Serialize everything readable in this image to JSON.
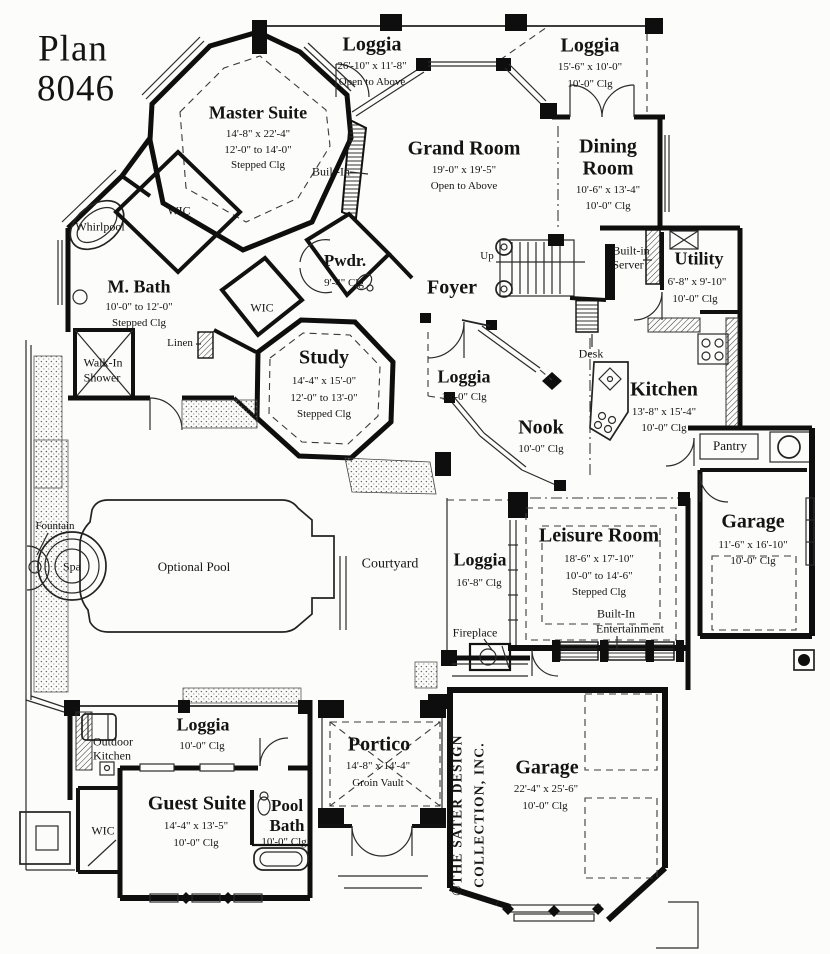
{
  "plan": {
    "title": "Plan",
    "number": "8046"
  },
  "copyright": {
    "line1": "©THE SATER DESIGN",
    "line2": "COLLECTION, INC."
  },
  "rooms": {
    "loggia_top": {
      "name": "Loggia",
      "dim": "26'-10\" x 11'-8\"",
      "note": "Open to Above"
    },
    "loggia_upper_right": {
      "name": "Loggia",
      "dim": "15'-6\" x 10'-0\"",
      "clg": "10'-0\" Clg"
    },
    "master_suite": {
      "name": "Master Suite",
      "dim": "14'-8\" x 22'-4\"",
      "clg": "12'-0\" to 14'-0\"",
      "clg2": "Stepped Clg"
    },
    "grand_room": {
      "name": "Grand Room",
      "dim": "19'-0\" x 19'-5\"",
      "note": "Open to Above"
    },
    "dining_room": {
      "name": "Dining",
      "name2": "Room",
      "dim": "10'-6\" x 13'-4\"",
      "clg": "10'-0\" Clg"
    },
    "m_bath": {
      "name": "M. Bath",
      "clg": "10'-0\" to 12'-0\"",
      "clg2": "Stepped Clg"
    },
    "pwdr": {
      "name": "Pwdr.",
      "clg": "9'-4\" Clg"
    },
    "study": {
      "name": "Study",
      "dim": "14'-4\" x 15'-0\"",
      "clg": "12'-0\" to 13'-0\"",
      "clg2": "Stepped Clg"
    },
    "foyer": {
      "name": "Foyer"
    },
    "utility": {
      "name": "Utility",
      "dim": "6'-8\" x 9'-10\"",
      "clg": "10'-0\" Clg"
    },
    "kitchen": {
      "name": "Kitchen",
      "dim": "13'-8\" x 15'-4\"",
      "clg": "10'-0\" Clg"
    },
    "nook": {
      "name": "Nook",
      "clg": "10'-0\" Clg"
    },
    "loggia_mid": {
      "name": "Loggia",
      "clg": "10'-0\" Clg"
    },
    "leisure": {
      "name": "Leisure Room",
      "dim": "18'-6\" x 17'-10\"",
      "clg": "10'-0\" to 14'-6\"",
      "clg2": "Stepped Clg"
    },
    "loggia_leisure": {
      "name": "Loggia",
      "clg": "16'-8\" Clg"
    },
    "garage_right": {
      "name": "Garage",
      "dim": "11'-6\" x 16'-10\"",
      "clg": "10'-0\" Clg"
    },
    "garage_main": {
      "name": "Garage",
      "dim": "22'-4\" x 25'-6\"",
      "clg": "10'-0\" Clg"
    },
    "guest_suite": {
      "name": "Guest Suite",
      "dim": "14'-4\" x 13'-5\"",
      "clg": "10'-0\" Clg"
    },
    "pool_bath": {
      "name": "Pool",
      "name2": "Bath",
      "clg": "10'-0\" Clg"
    },
    "loggia_rear": {
      "name": "Loggia",
      "clg": "10'-0\" Clg"
    },
    "portico": {
      "name": "Portico",
      "dim": "14'-8\" x 14'-4\"",
      "note": "Groin Vault"
    },
    "courtyard": {
      "name": "Courtyard"
    }
  },
  "features": {
    "wic": "WIC",
    "whirlpool": "Whirlpool",
    "built_in": "Built-In",
    "linen": "Linen",
    "walk_in_1": "Walk-In",
    "walk_in_2": "Shower",
    "up": "Up",
    "desk": "Desk",
    "server_1": "Built-in",
    "server_2": "Server",
    "pantry": "Pantry",
    "fireplace": "Fireplace",
    "ent_1": "Built-In",
    "ent_2": "Entertainment",
    "fountain": "Fountain",
    "spa": "Spa",
    "pool": "Optional Pool",
    "outdoor_1": "Outdoor",
    "outdoor_2": "Kitchen"
  }
}
